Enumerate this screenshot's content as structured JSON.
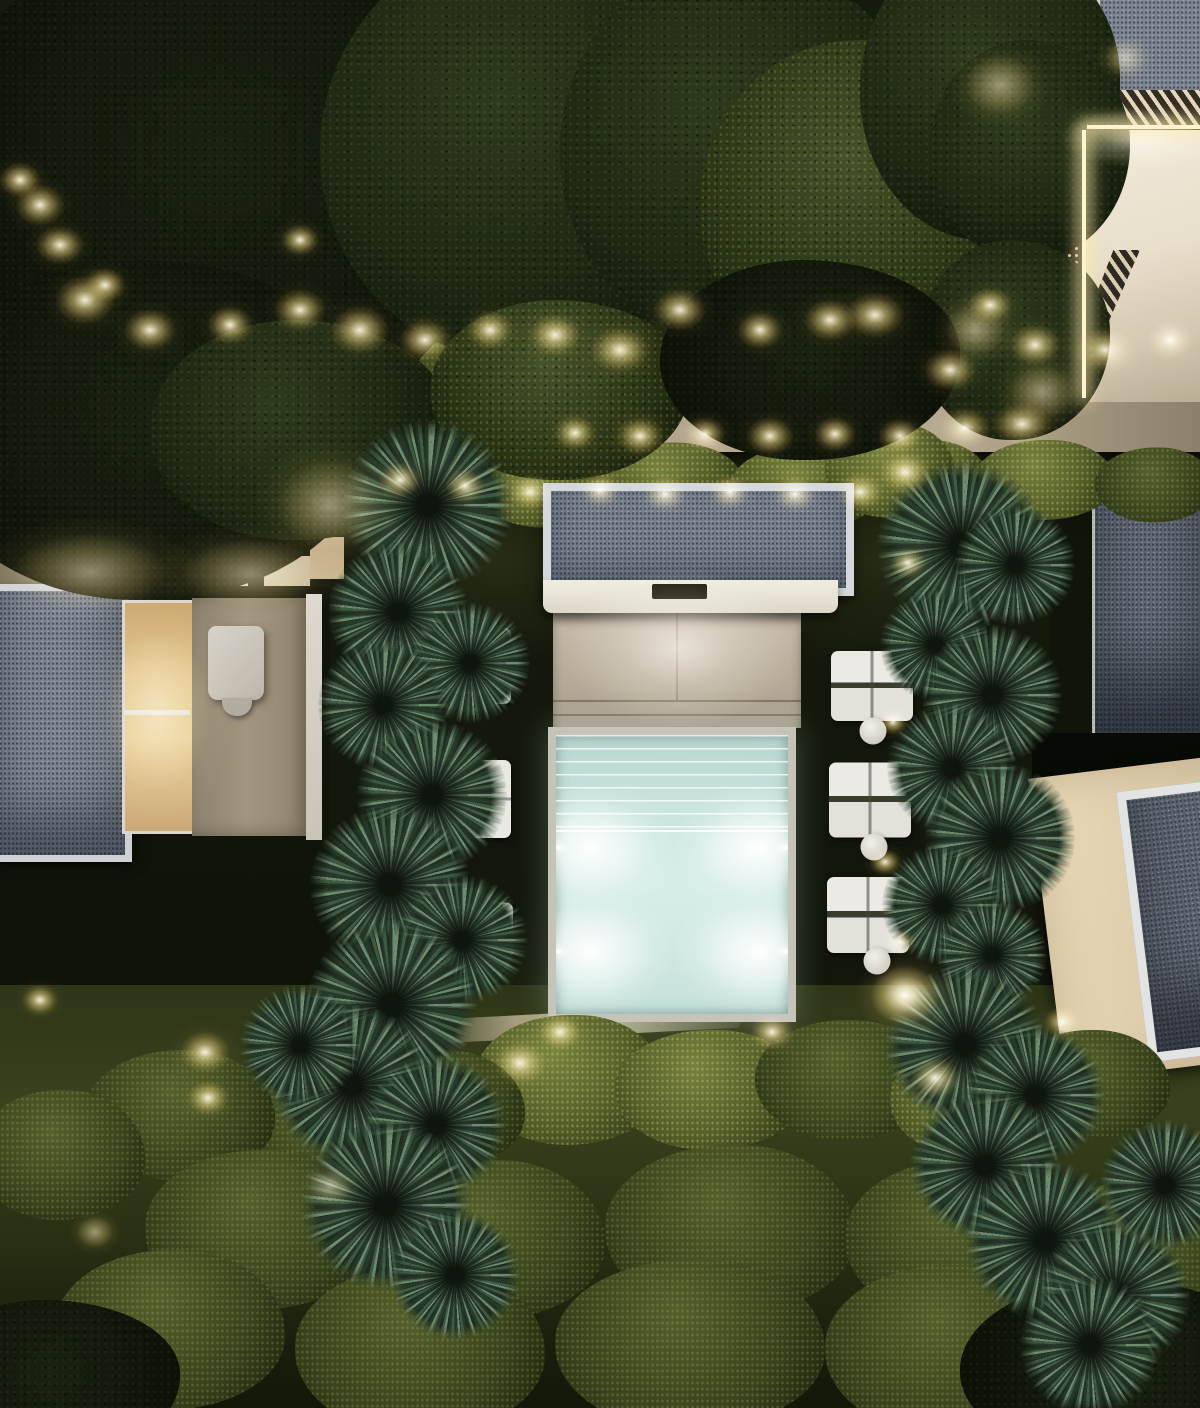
{
  "scene": {
    "description": "Night-time aerial drone view of a modern villa garden: illuminated turquoise plunge pool with entry steps and four underwater lights, gravel-roof pavilion with ceiling light slot over a stone deck, flat gravel roofs of surrounding villas, dot-grid pergola screens lit from below at top right, stepping-stone paths, white sun loungers with round side tables, columns of round palm trees, hedges, retaining wall with warm up-lights and many garden spotlights in dark foliage",
    "time_of_day": "night",
    "visible_text": "none",
    "colors": {
      "night_lawn": "#12160b",
      "canopy_dark": "#1f2913",
      "foliage_lit": "#55602c",
      "palm_green": "#405c44",
      "warm_light": "#f4da8a",
      "pool_water": "#cde8e2",
      "pool_glow": "#ffffff",
      "deck_stone": "#b9ae9c",
      "wall_white": "#e8dfcc",
      "gravel_roof": "#75808c",
      "roof_frame_white": "#d4d8da",
      "lounger_white": "#eceae4"
    },
    "counts": {
      "pool_underwater_lights": 4,
      "right_lounger_groups": 3,
      "side_tables": 3
    }
  },
  "sprites": [
    {
      "c": "tree darkest",
      "x": 220,
      "y": 180,
      "w": 560,
      "h": 520
    },
    {
      "c": "tree",
      "x": 530,
      "y": 150,
      "w": 420,
      "h": 420
    },
    {
      "c": "tree",
      "x": 740,
      "y": 150,
      "w": 360,
      "h": 380
    },
    {
      "c": "tree lit",
      "x": 865,
      "y": 205,
      "w": 330,
      "h": 330
    },
    {
      "c": "tree",
      "x": 990,
      "y": 90,
      "w": 260,
      "h": 300
    },
    {
      "c": "tree",
      "x": 1030,
      "y": 150,
      "w": 200,
      "h": 220
    },
    {
      "c": "tree",
      "x": 1015,
      "y": 340,
      "w": 190,
      "h": 200
    },
    {
      "c": "tree darkest",
      "x": 150,
      "y": 430,
      "w": 460,
      "h": 340
    },
    {
      "c": "tree",
      "x": 300,
      "y": 430,
      "w": 300,
      "h": 220
    },
    {
      "c": "tree lit",
      "x": 560,
      "y": 390,
      "w": 260,
      "h": 180
    },
    {
      "c": "tree darkest",
      "x": 810,
      "y": 360,
      "w": 300,
      "h": 200
    },
    {
      "c": "tree darkest",
      "x": 1120,
      "y": 1370,
      "w": 320,
      "h": 180
    },
    {
      "c": "tree darkest",
      "x": 50,
      "y": 1380,
      "w": 260,
      "h": 160
    },
    {
      "c": "bush lit",
      "x": 410,
      "y": 480,
      "w": 130,
      "h": 80
    },
    {
      "c": "bush lit",
      "x": 545,
      "y": 485,
      "w": 140,
      "h": 85
    },
    {
      "c": "bush lit",
      "x": 670,
      "y": 485,
      "w": 150,
      "h": 85
    },
    {
      "c": "bush lit",
      "x": 805,
      "y": 488,
      "w": 150,
      "h": 85
    },
    {
      "c": "bush lit",
      "x": 925,
      "y": 480,
      "w": 130,
      "h": 80
    },
    {
      "c": "bush lit",
      "x": 1045,
      "y": 480,
      "w": 140,
      "h": 80
    },
    {
      "c": "bush",
      "x": 1155,
      "y": 485,
      "w": 120,
      "h": 75
    },
    {
      "c": "bush lit",
      "x": 890,
      "y": 470,
      "w": 130,
      "h": 95
    },
    {
      "c": "bush",
      "x": 350,
      "y": 380,
      "w": 150,
      "h": 70
    },
    {
      "c": "bush",
      "x": 480,
      "y": 372,
      "w": 150,
      "h": 70
    },
    {
      "c": "bush lit",
      "x": 570,
      "y": 1080,
      "w": 190,
      "h": 130
    },
    {
      "c": "bush lit",
      "x": 710,
      "y": 1090,
      "w": 190,
      "h": 120
    },
    {
      "c": "bush",
      "x": 845,
      "y": 1080,
      "w": 180,
      "h": 120
    },
    {
      "c": "bush",
      "x": 440,
      "y": 1110,
      "w": 170,
      "h": 120
    },
    {
      "c": "bush",
      "x": 325,
      "y": 1130,
      "w": 180,
      "h": 120
    },
    {
      "c": "bush",
      "x": 180,
      "y": 1115,
      "w": 190,
      "h": 130
    },
    {
      "c": "bush",
      "x": 60,
      "y": 1155,
      "w": 170,
      "h": 130
    },
    {
      "c": "bush lit",
      "x": 975,
      "y": 1100,
      "w": 170,
      "h": 115
    },
    {
      "c": "bush",
      "x": 1090,
      "y": 1085,
      "w": 160,
      "h": 110
    },
    {
      "c": "bush",
      "x": 260,
      "y": 1230,
      "w": 230,
      "h": 160
    },
    {
      "c": "bush",
      "x": 490,
      "y": 1240,
      "w": 230,
      "h": 160
    },
    {
      "c": "bush",
      "x": 730,
      "y": 1230,
      "w": 250,
      "h": 170
    },
    {
      "c": "bush",
      "x": 960,
      "y": 1240,
      "w": 230,
      "h": 160
    },
    {
      "c": "bush",
      "x": 170,
      "y": 1330,
      "w": 230,
      "h": 160
    },
    {
      "c": "bush",
      "x": 420,
      "y": 1350,
      "w": 250,
      "h": 170
    },
    {
      "c": "bush",
      "x": 690,
      "y": 1345,
      "w": 270,
      "h": 170
    },
    {
      "c": "bush",
      "x": 950,
      "y": 1350,
      "w": 250,
      "h": 170
    },
    {
      "c": "bush",
      "x": 1140,
      "y": 1255,
      "w": 210,
      "h": 150
    },
    {
      "c": "palm",
      "x": 428,
      "y": 505,
      "w": 170,
      "h": 170
    },
    {
      "c": "palm",
      "x": 398,
      "y": 612,
      "w": 140,
      "h": 140
    },
    {
      "c": "palm",
      "x": 470,
      "y": 663,
      "w": 120,
      "h": 120
    },
    {
      "c": "palm",
      "x": 383,
      "y": 705,
      "w": 130,
      "h": 130
    },
    {
      "c": "palm",
      "x": 432,
      "y": 795,
      "w": 150,
      "h": 150
    },
    {
      "c": "palm",
      "x": 390,
      "y": 885,
      "w": 160,
      "h": 160
    },
    {
      "c": "palm",
      "x": 462,
      "y": 940,
      "w": 130,
      "h": 130
    },
    {
      "c": "palm",
      "x": 392,
      "y": 1005,
      "w": 170,
      "h": 170
    },
    {
      "c": "palm",
      "x": 352,
      "y": 1085,
      "w": 160,
      "h": 160
    },
    {
      "c": "palm",
      "x": 436,
      "y": 1125,
      "w": 140,
      "h": 140
    },
    {
      "c": "palm",
      "x": 386,
      "y": 1205,
      "w": 170,
      "h": 170
    },
    {
      "c": "palm",
      "x": 455,
      "y": 1275,
      "w": 130,
      "h": 130
    },
    {
      "c": "palm",
      "x": 300,
      "y": 1045,
      "w": 120,
      "h": 120
    },
    {
      "c": "palm",
      "x": 962,
      "y": 545,
      "w": 170,
      "h": 170
    },
    {
      "c": "palm",
      "x": 1015,
      "y": 565,
      "w": 120,
      "h": 120
    },
    {
      "c": "palm",
      "x": 935,
      "y": 645,
      "w": 110,
      "h": 110
    },
    {
      "c": "palm",
      "x": 992,
      "y": 695,
      "w": 140,
      "h": 140
    },
    {
      "c": "palm",
      "x": 952,
      "y": 768,
      "w": 130,
      "h": 130
    },
    {
      "c": "palm",
      "x": 1000,
      "y": 838,
      "w": 150,
      "h": 150
    },
    {
      "c": "palm",
      "x": 942,
      "y": 905,
      "w": 120,
      "h": 120
    },
    {
      "c": "palm",
      "x": 992,
      "y": 955,
      "w": 110,
      "h": 110
    },
    {
      "c": "palm",
      "x": 965,
      "y": 1045,
      "w": 160,
      "h": 160
    },
    {
      "c": "palm",
      "x": 1035,
      "y": 1095,
      "w": 140,
      "h": 140
    },
    {
      "c": "palm",
      "x": 985,
      "y": 1165,
      "w": 150,
      "h": 150
    },
    {
      "c": "palm",
      "x": 1045,
      "y": 1240,
      "w": 160,
      "h": 160
    },
    {
      "c": "palm",
      "x": 1115,
      "y": 1295,
      "w": 150,
      "h": 150
    },
    {
      "c": "palm",
      "x": 1165,
      "y": 1185,
      "w": 130,
      "h": 130
    },
    {
      "c": "palm",
      "x": 1090,
      "y": 1345,
      "w": 140,
      "h": 140
    },
    {
      "c": "lounger",
      "x": 872,
      "y": 686,
      "w": 82,
      "h": 70
    },
    {
      "c": "lounger",
      "x": 870,
      "y": 800,
      "w": 82,
      "h": 75
    },
    {
      "c": "lounger",
      "x": 868,
      "y": 915,
      "w": 82,
      "h": 76
    },
    {
      "c": "table",
      "x": 873,
      "y": 731,
      "w": 27,
      "h": 27
    },
    {
      "c": "table",
      "x": 874,
      "y": 847,
      "w": 27,
      "h": 27
    },
    {
      "c": "table",
      "x": 877,
      "y": 961,
      "w": 27,
      "h": 27
    },
    {
      "c": "lounger single",
      "x": 479,
      "y": 666,
      "w": 64,
      "h": 76
    },
    {
      "c": "lounger single",
      "x": 476,
      "y": 799,
      "w": 70,
      "h": 78
    },
    {
      "c": "lounger single",
      "x": 498,
      "y": 930,
      "w": 30,
      "h": 55
    },
    {
      "c": "slab",
      "x": 35,
      "y": 490,
      "w": 70,
      "h": 38
    },
    {
      "c": "slab",
      "x": 35,
      "y": 536,
      "w": 70,
      "h": 38
    },
    {
      "c": "glow",
      "x": 40,
      "y": 205,
      "w": 70,
      "h": 60
    },
    {
      "c": "glow",
      "x": 85,
      "y": 300,
      "w": 85,
      "h": 70
    },
    {
      "c": "glow",
      "x": 150,
      "y": 330,
      "w": 75,
      "h": 60
    },
    {
      "c": "glow",
      "x": 230,
      "y": 325,
      "w": 65,
      "h": 55
    },
    {
      "c": "glow",
      "x": 300,
      "y": 310,
      "w": 75,
      "h": 60
    },
    {
      "c": "glow",
      "x": 360,
      "y": 330,
      "w": 85,
      "h": 70
    },
    {
      "c": "glow",
      "x": 425,
      "y": 340,
      "w": 75,
      "h": 60
    },
    {
      "c": "glow",
      "x": 490,
      "y": 330,
      "w": 65,
      "h": 55
    },
    {
      "c": "glow",
      "x": 555,
      "y": 335,
      "w": 75,
      "h": 60
    },
    {
      "c": "glow",
      "x": 300,
      "y": 240,
      "w": 55,
      "h": 45
    },
    {
      "c": "glow",
      "x": 20,
      "y": 180,
      "w": 60,
      "h": 50
    },
    {
      "c": "glow",
      "x": 60,
      "y": 245,
      "w": 70,
      "h": 55
    },
    {
      "c": "glow",
      "x": 105,
      "y": 285,
      "w": 60,
      "h": 50
    },
    {
      "c": "glow",
      "x": 620,
      "y": 350,
      "w": 85,
      "h": 65
    },
    {
      "c": "glow",
      "x": 680,
      "y": 310,
      "w": 75,
      "h": 60
    },
    {
      "c": "glow",
      "x": 760,
      "y": 330,
      "w": 65,
      "h": 55
    },
    {
      "c": "glow",
      "x": 830,
      "y": 320,
      "w": 75,
      "h": 60
    },
    {
      "c": "glow",
      "x": 875,
      "y": 315,
      "w": 85,
      "h": 65
    },
    {
      "c": "glow",
      "x": 950,
      "y": 370,
      "w": 75,
      "h": 60
    },
    {
      "c": "glow",
      "x": 990,
      "y": 305,
      "w": 65,
      "h": 50
    },
    {
      "c": "glow",
      "x": 1035,
      "y": 345,
      "w": 75,
      "h": 60
    },
    {
      "c": "glow",
      "x": 1105,
      "y": 350,
      "w": 85,
      "h": 65
    },
    {
      "c": "glow",
      "x": 1170,
      "y": 340,
      "w": 65,
      "h": 55
    },
    {
      "c": "glow",
      "x": 575,
      "y": 433,
      "w": 60,
      "h": 50
    },
    {
      "c": "glow",
      "x": 640,
      "y": 436,
      "w": 68,
      "h": 55
    },
    {
      "c": "glow",
      "x": 705,
      "y": 434,
      "w": 60,
      "h": 50
    },
    {
      "c": "glow",
      "x": 770,
      "y": 436,
      "w": 68,
      "h": 55
    },
    {
      "c": "glow",
      "x": 835,
      "y": 434,
      "w": 60,
      "h": 50
    },
    {
      "c": "glow",
      "x": 900,
      "y": 436,
      "w": 62,
      "h": 50
    },
    {
      "c": "glow",
      "x": 965,
      "y": 428,
      "w": 72,
      "h": 58
    },
    {
      "c": "glow",
      "x": 1022,
      "y": 424,
      "w": 85,
      "h": 60
    },
    {
      "c": "glow",
      "x": 400,
      "y": 480,
      "w": 60,
      "h": 50
    },
    {
      "c": "glow",
      "x": 465,
      "y": 486,
      "w": 56,
      "h": 48
    },
    {
      "c": "glow",
      "x": 530,
      "y": 492,
      "w": 62,
      "h": 50
    },
    {
      "c": "glow",
      "x": 600,
      "y": 490,
      "w": 56,
      "h": 48
    },
    {
      "c": "glow",
      "x": 665,
      "y": 494,
      "w": 62,
      "h": 50
    },
    {
      "c": "glow",
      "x": 730,
      "y": 492,
      "w": 56,
      "h": 48
    },
    {
      "c": "glow",
      "x": 795,
      "y": 494,
      "w": 62,
      "h": 50
    },
    {
      "c": "glow",
      "x": 860,
      "y": 492,
      "w": 66,
      "h": 54
    },
    {
      "c": "glow",
      "x": 905,
      "y": 472,
      "w": 72,
      "h": 60
    },
    {
      "c": "glow soft",
      "x": 90,
      "y": 572,
      "w": 220,
      "h": 110
    },
    {
      "c": "glow soft",
      "x": 250,
      "y": 574,
      "w": 200,
      "h": 100
    },
    {
      "c": "glow soft",
      "x": 330,
      "y": 505,
      "w": 150,
      "h": 130
    },
    {
      "c": "glow soft",
      "x": 158,
      "y": 712,
      "w": 150,
      "h": 230
    },
    {
      "c": "glow pale",
      "x": 679,
      "y": 648,
      "w": 230,
      "h": 160
    },
    {
      "c": "glow",
      "x": 560,
      "y": 1032,
      "w": 62,
      "h": 50
    },
    {
      "c": "glow",
      "x": 772,
      "y": 1032,
      "w": 62,
      "h": 50
    },
    {
      "c": "glow",
      "x": 520,
      "y": 1063,
      "w": 75,
      "h": 60
    },
    {
      "c": "glow",
      "x": 935,
      "y": 1078,
      "w": 70,
      "h": 58
    },
    {
      "c": "glow bright",
      "x": 905,
      "y": 995,
      "w": 100,
      "h": 85
    },
    {
      "c": "glow",
      "x": 205,
      "y": 1052,
      "w": 72,
      "h": 60
    },
    {
      "c": "glow",
      "x": 208,
      "y": 1098,
      "w": 60,
      "h": 50
    },
    {
      "c": "glow",
      "x": 40,
      "y": 1000,
      "w": 52,
      "h": 44
    },
    {
      "c": "glow soft",
      "x": 330,
      "y": 1186,
      "w": 60,
      "h": 50
    },
    {
      "c": "glow soft",
      "x": 95,
      "y": 1232,
      "w": 52,
      "h": 44
    },
    {
      "c": "glow",
      "x": 908,
      "y": 563,
      "w": 52,
      "h": 44
    },
    {
      "c": "glow",
      "x": 893,
      "y": 722,
      "w": 42,
      "h": 36
    },
    {
      "c": "glow",
      "x": 885,
      "y": 862,
      "w": 46,
      "h": 38
    },
    {
      "c": "glow",
      "x": 900,
      "y": 942,
      "w": 42,
      "h": 36
    },
    {
      "c": "glow",
      "x": 1062,
      "y": 1022,
      "w": 52,
      "h": 44
    },
    {
      "c": "glow soft",
      "x": 1000,
      "y": 85,
      "w": 100,
      "h": 85
    },
    {
      "c": "glow soft",
      "x": 975,
      "y": 330,
      "w": 85,
      "h": 75
    },
    {
      "c": "glow soft",
      "x": 1042,
      "y": 392,
      "w": 95,
      "h": 80
    },
    {
      "c": "glow soft",
      "x": 1125,
      "y": 58,
      "w": 60,
      "h": 50
    },
    {
      "c": "glow soft pale",
      "x": 1140,
      "y": 138,
      "w": 160,
      "h": 60
    }
  ]
}
